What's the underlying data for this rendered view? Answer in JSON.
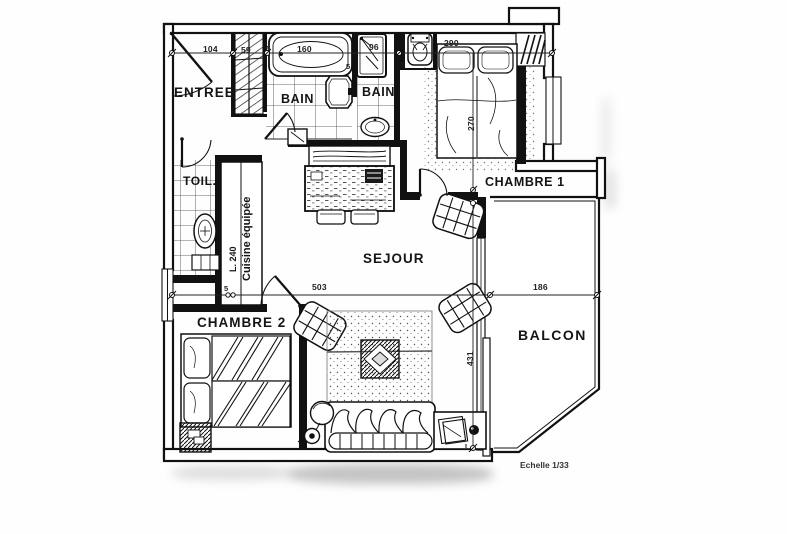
{
  "plan": {
    "scale_note": "Echelle 1/33",
    "ink_color": "#1a1a1a",
    "paper_color": "#ffffff",
    "rooms": {
      "entree": "ENTREE",
      "bain1": "BAIN",
      "bain2": "BAIN",
      "toilettes": "TOIL.",
      "chambre1": "CHAMBRE 1",
      "chambre2": "CHAMBRE 2",
      "sejour": "SEJOUR",
      "balcon": "BALCON",
      "cuisine": "Cuisine équipée",
      "cuisine_longueur": "L. 240"
    },
    "dimensions": {
      "entree_largeur": "104",
      "placard_largeur": "59",
      "baignoire_longueur": "160",
      "douche_largeur": "96",
      "chambre1_largeur": "290",
      "chambre1_profondeur": "270",
      "cloison_baignoire_gauche": "5",
      "cloison_baignoire_droite": "5",
      "cloison_cuisine": "5",
      "cloison_wc": "3",
      "sejour_largeur": "503",
      "sejour_profondeur": "431",
      "balcon_largeur": "186"
    }
  }
}
